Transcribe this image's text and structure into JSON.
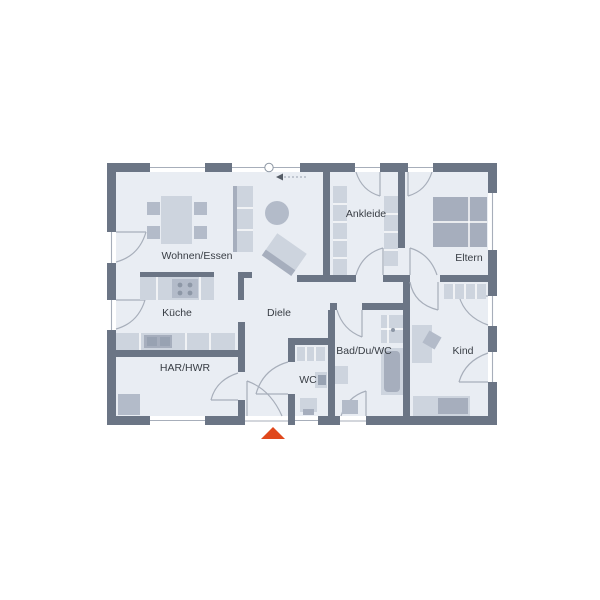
{
  "plan": {
    "rooms": [
      {
        "id": "wohnen-essen",
        "label": "Wohnen/Essen"
      },
      {
        "id": "ankleide",
        "label": "Ankleide"
      },
      {
        "id": "eltern",
        "label": "Eltern"
      },
      {
        "id": "kueche",
        "label": "Küche"
      },
      {
        "id": "diele",
        "label": "Diele"
      },
      {
        "id": "bad-du-wc",
        "label": "Bad/Du/WC"
      },
      {
        "id": "kind",
        "label": "Kind"
      },
      {
        "id": "har-hwr",
        "label": "HAR/HWR"
      },
      {
        "id": "wc",
        "label": "WC"
      }
    ],
    "colors": {
      "wall": "#6b7585",
      "floor": "#e9edf3",
      "furniture_light": "#cdd4de",
      "furniture_mid": "#b3bbc9",
      "furniture_dark": "#a6aebd",
      "line": "#a7aeba",
      "text": "#383d44",
      "entrance_marker": "#e0481c"
    }
  }
}
